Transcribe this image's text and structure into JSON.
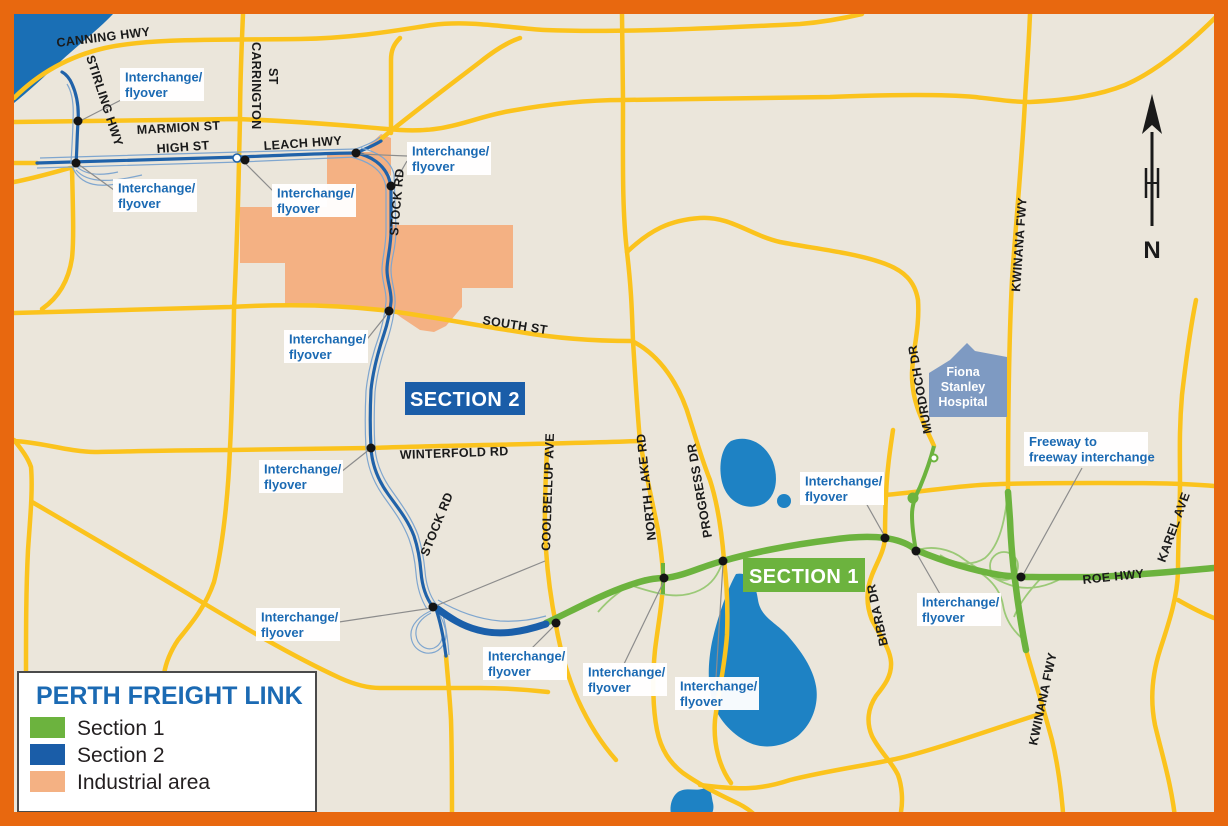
{
  "legend": {
    "title": "PERTH FREIGHT LINK",
    "items": [
      {
        "label": "Section 1",
        "color": "#6CB33E"
      },
      {
        "label": "Section 2",
        "color": "#1A5DA8"
      },
      {
        "label": "Industrial area",
        "color": "#F4B183"
      }
    ]
  },
  "badges": {
    "section1": "SECTION 1",
    "section2": "SECTION 2"
  },
  "roads": {
    "canning_hwy": "CANNING HWY",
    "stirling_hwy": "STIRLING HWY",
    "marmion_st": "MARMION ST",
    "high_st": "HIGH ST",
    "carrington": "CARRINGTON",
    "carrington_st2": "ST",
    "leach_hwy": "LEACH HWY",
    "stock_rd": "STOCK RD",
    "south_st": "SOUTH ST",
    "winterfold_rd": "WINTERFOLD RD",
    "coolbellup_ave": "COOLBELLUP AVE",
    "north_lake_rd": "NORTH LAKE RD",
    "progress_dr": "PROGRESS DR",
    "bibra_dr": "BIBRA DR",
    "murdoch_dr": "MURDOCH DR",
    "kwinana_fwy": "KWINANA FWY",
    "karel_ave": "KAREL AVE",
    "roe_hwy": "ROE HWY"
  },
  "labels": {
    "interchange": {
      "line1": "Interchange/",
      "line2": "flyover"
    },
    "freeway": {
      "line1": "Freeway to",
      "line2": "freeway interchange"
    },
    "hospital": {
      "line1": "Fiona",
      "line2": "Stanley",
      "line3": "Hospital"
    },
    "compass_north": "N"
  },
  "colors": {
    "border_orange": "#E8680F",
    "background_beige": "#EBE6DB",
    "road_yellow": "#FBC31D",
    "section1_green": "#6CB33E",
    "section2_blue": "#1A5DA8",
    "industrial_orange": "#F4B183",
    "water_blue": "#1E82C4",
    "hospital_fill": "#7E9AC2",
    "annotation_blue": "#1B6AB3"
  }
}
